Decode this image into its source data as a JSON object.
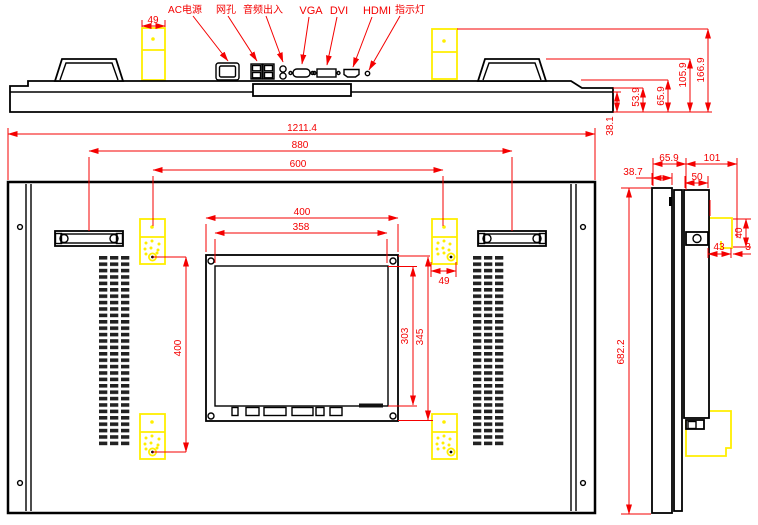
{
  "colors": {
    "dimension": "#f40000",
    "highlight": "#ffee00",
    "line": "#000000"
  },
  "connector_labels": {
    "ac_power": "AC电源",
    "lan": "网孔",
    "audio": "音频出入",
    "vga": "VGA",
    "dvi": "DVI",
    "hdmi": "HDMI",
    "indicator": "指示灯"
  },
  "dims": {
    "top": {
      "bracket_width": "49",
      "panel_depth": "38.1",
      "step_depth": "53.9",
      "body_depth": "65.9",
      "handle_depth": "105.9",
      "overall_depth": "166.9"
    },
    "rear": {
      "overall_width": "1211.4",
      "handle_spacing": "880",
      "mount_hole_width": "600",
      "box_width": "400",
      "box_inner_width": "358",
      "box_inner_height": "303",
      "box_height": "345",
      "mount_hole_height": "400",
      "plate_width": "49",
      "overall_height": "682.2"
    },
    "side": {
      "panel_depth": "38.7",
      "bezel_depth": "65.9",
      "mount_depth": "101",
      "box_depth": "50",
      "hook_height": "40",
      "hook_width": "43",
      "hook_lip": "3"
    }
  }
}
